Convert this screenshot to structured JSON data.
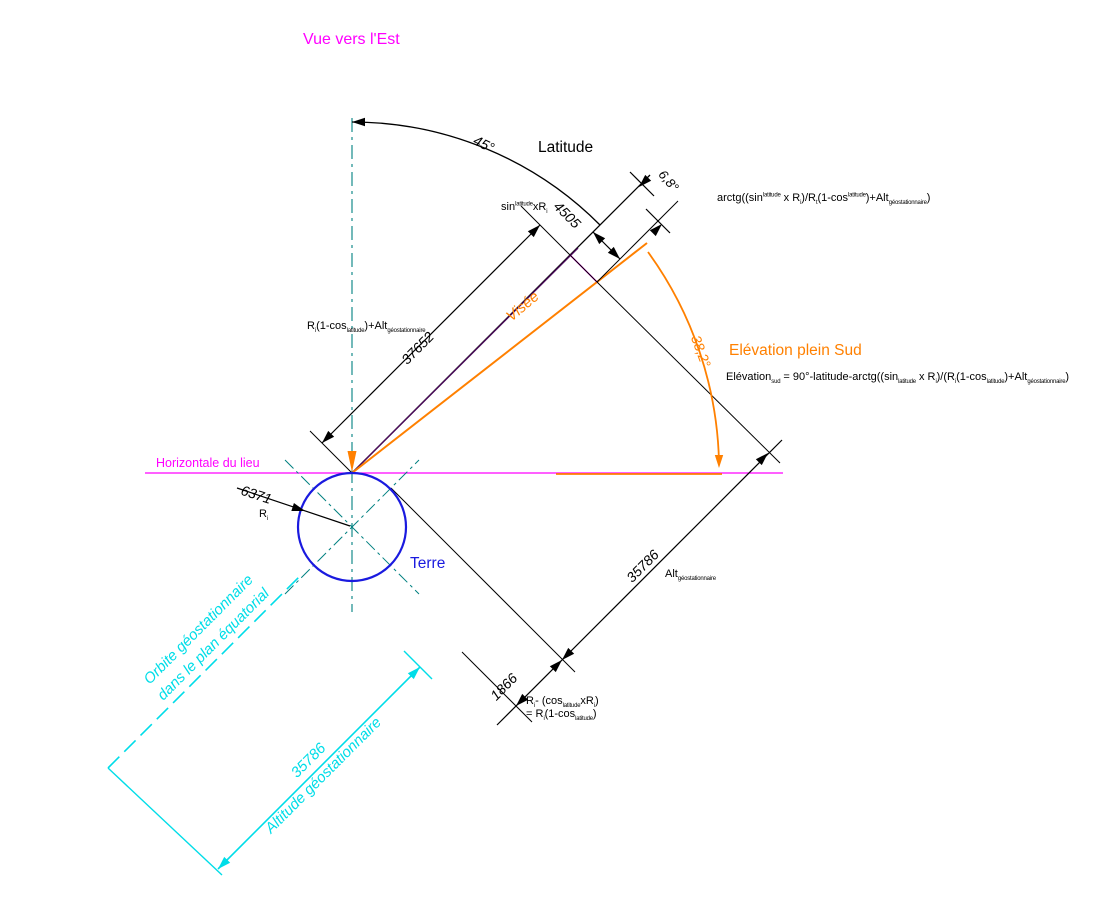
{
  "title": "Vue vers l'Est",
  "colors": {
    "magenta": "#FF00FF",
    "orange": "#FF8000",
    "earth_blue": "#1A1ADF",
    "cyan": "#00DDE8",
    "teal_axis": "#008080",
    "line_black": "#000000",
    "purple_sight": "#4A0A5A"
  },
  "labels": {
    "view": "Vue vers l'Est",
    "latitude": "Latitude",
    "visee": "Visée",
    "elevation_title": "Elévation plein Sud",
    "horizontal": "Horizontale du lieu",
    "earth": "Terre",
    "orbit_line1": "Orbite géostationnaire",
    "orbit_line2": "dans le plan équatorial",
    "geo_alt_value": "35786",
    "geo_alt_caption": "Altitude géostationnaire"
  },
  "dimensions": {
    "latitude_angle": "45°",
    "parallax_angle": "6,8°",
    "sin_offset": "4505",
    "total_distance": "37652",
    "elevation_angle": "38,2°",
    "earth_radius": "6371",
    "geo_altitude": "35786",
    "radial_offset": "1866"
  },
  "formulas": {
    "arctg": "arctg((sin^{latitude} x R_{i})/R_{t}(1-cos^{latitude})+Alt_{géostationnaire})",
    "elevation": "Elévation_{sud} = 90°-latitude-arctg((sin_{latitude} x R_{i})/(R_{i}(1-cos_{latitude})+Alt_{géostationnaire})",
    "sin_label": "sin^{latitude}xR_{i}",
    "ri_label": "R_{i}(1-cos_{latitude})+Alt_{géostationnaire}",
    "alt_label": "Alt_{géostationnaire}",
    "ri_small": "R_{i}",
    "rg_line1": "R_{i}- (cos_{latitude}xR_{i})",
    "rg_line2": "= R_{i}(1-cos_{latitude})"
  }
}
